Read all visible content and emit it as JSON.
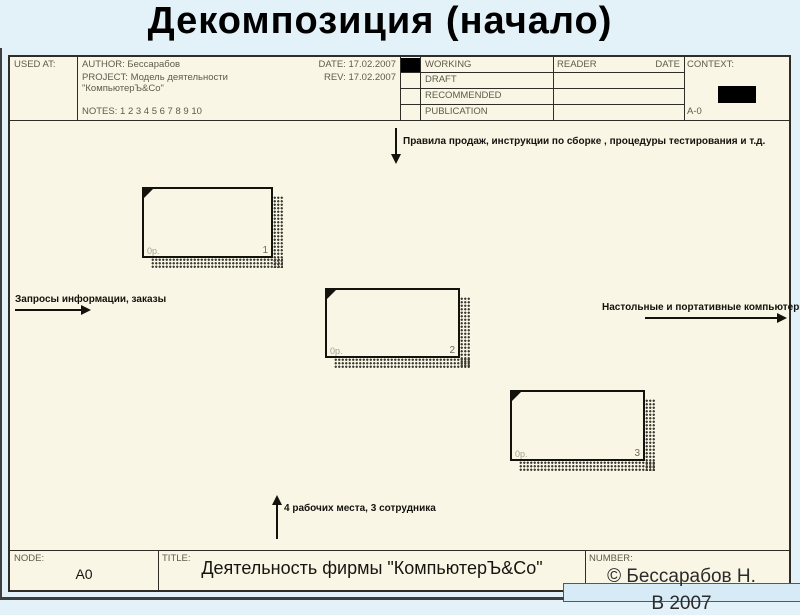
{
  "slide": {
    "title": "Декомпозиция (начало)"
  },
  "colors": {
    "slide_bg": "#e3f1f9",
    "form_bg": "#faf6e6",
    "line": "#2f2d28",
    "header_text": "#5d5b4d",
    "marker_fill": "#000000"
  },
  "form": {
    "header": {
      "used_at_label": "USED AT:",
      "author_label": "AUTHOR:",
      "author_value": "Бессарабов",
      "project_label": "PROJECT:",
      "project_value": "Модель деятельности",
      "project_value2": "\"КомпьютерЪ&Co\"",
      "notes_label": "NOTES:",
      "notes_value": "1 2 3 4 5 6 7 8 9 10",
      "date_label": "DATE:",
      "date_value": "17.02.2007",
      "rev_label": "REV:",
      "rev_value": "17.02.2007",
      "status_rows": [
        "WORKING",
        "DRAFT",
        "RECOMMENDED",
        "PUBLICATION"
      ],
      "reader_label": "READER",
      "reader_date_label": "DATE",
      "context_label": "CONTEXT:",
      "context_node": "A-0"
    },
    "diagram": {
      "control_arrow_label": "Правила продаж, инструкции по сборке , процедуры тестирования и т.д.",
      "input_arrow_label": "Запросы информации, заказы",
      "output_arrow_label": "Настольные и портативные компьютеры",
      "mechanism_arrow_label": "4 рабочих места, 3 сотрудника",
      "boxes": [
        {
          "cost": "0р.",
          "number": "1"
        },
        {
          "cost": "0р.",
          "number": "2"
        },
        {
          "cost": "0р.",
          "number": "3"
        }
      ]
    },
    "footer": {
      "node_label": "NODE:",
      "node_value": "A0",
      "title_label": "TITLE:",
      "title_value": "Деятельность фирмы \"КомпьютерЪ&Co\"",
      "number_label": "NUMBER:"
    }
  },
  "copyright": {
    "line1": "© Бессарабов Н.",
    "line2": "В 2007"
  }
}
